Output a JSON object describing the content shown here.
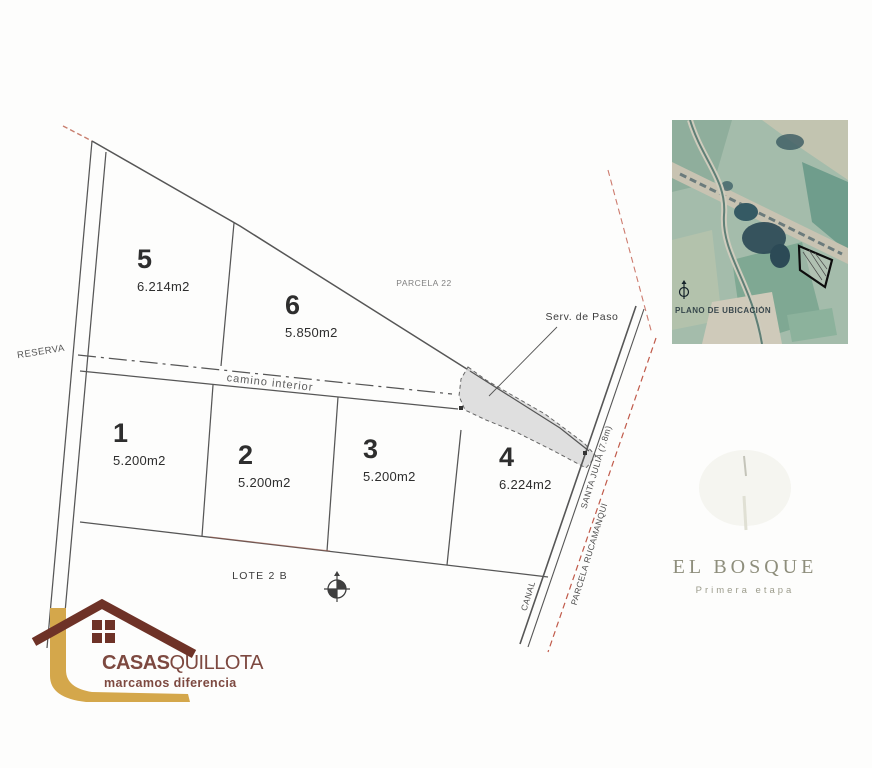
{
  "plan": {
    "parcels": [
      {
        "number": "1",
        "area": "5.200m2"
      },
      {
        "number": "2",
        "area": "5.200m2"
      },
      {
        "number": "3",
        "area": "5.200m2"
      },
      {
        "number": "4",
        "area": "6.224m2"
      },
      {
        "number": "5",
        "area": "6.214m2"
      },
      {
        "number": "6",
        "area": "5.850m2"
      }
    ],
    "labels": {
      "reserva": "RESERVA",
      "parcela22": "PARCELA 22",
      "serv_de_paso": "Serv. de Paso",
      "camino_interior": "camino interior",
      "lote2b": "LOTE 2 B",
      "canal": "CANAL",
      "santa_julia": "SANTA JULIA (7.8m)",
      "parcela_rucamanqui": "PARCELA RUCAMANQUI"
    }
  },
  "inset": {
    "caption": "PLANO DE UBICACIÓN"
  },
  "branding": {
    "el_bosque": {
      "title": "EL BOSQUE",
      "subtitle": "Primera etapa"
    },
    "casas_quillota": {
      "name_bold": "CASAS",
      "name_light": "QUILLOTA",
      "tagline": "marcamos diferencia"
    }
  },
  "colors": {
    "line": "#565656",
    "red_dash": "#c05a4a",
    "easement_fill": "#d9d9d9",
    "maroon": "#7d4940",
    "roof_brown": "#6e3227",
    "gold": "#d4a74b",
    "olive": "#8e8e7c"
  }
}
